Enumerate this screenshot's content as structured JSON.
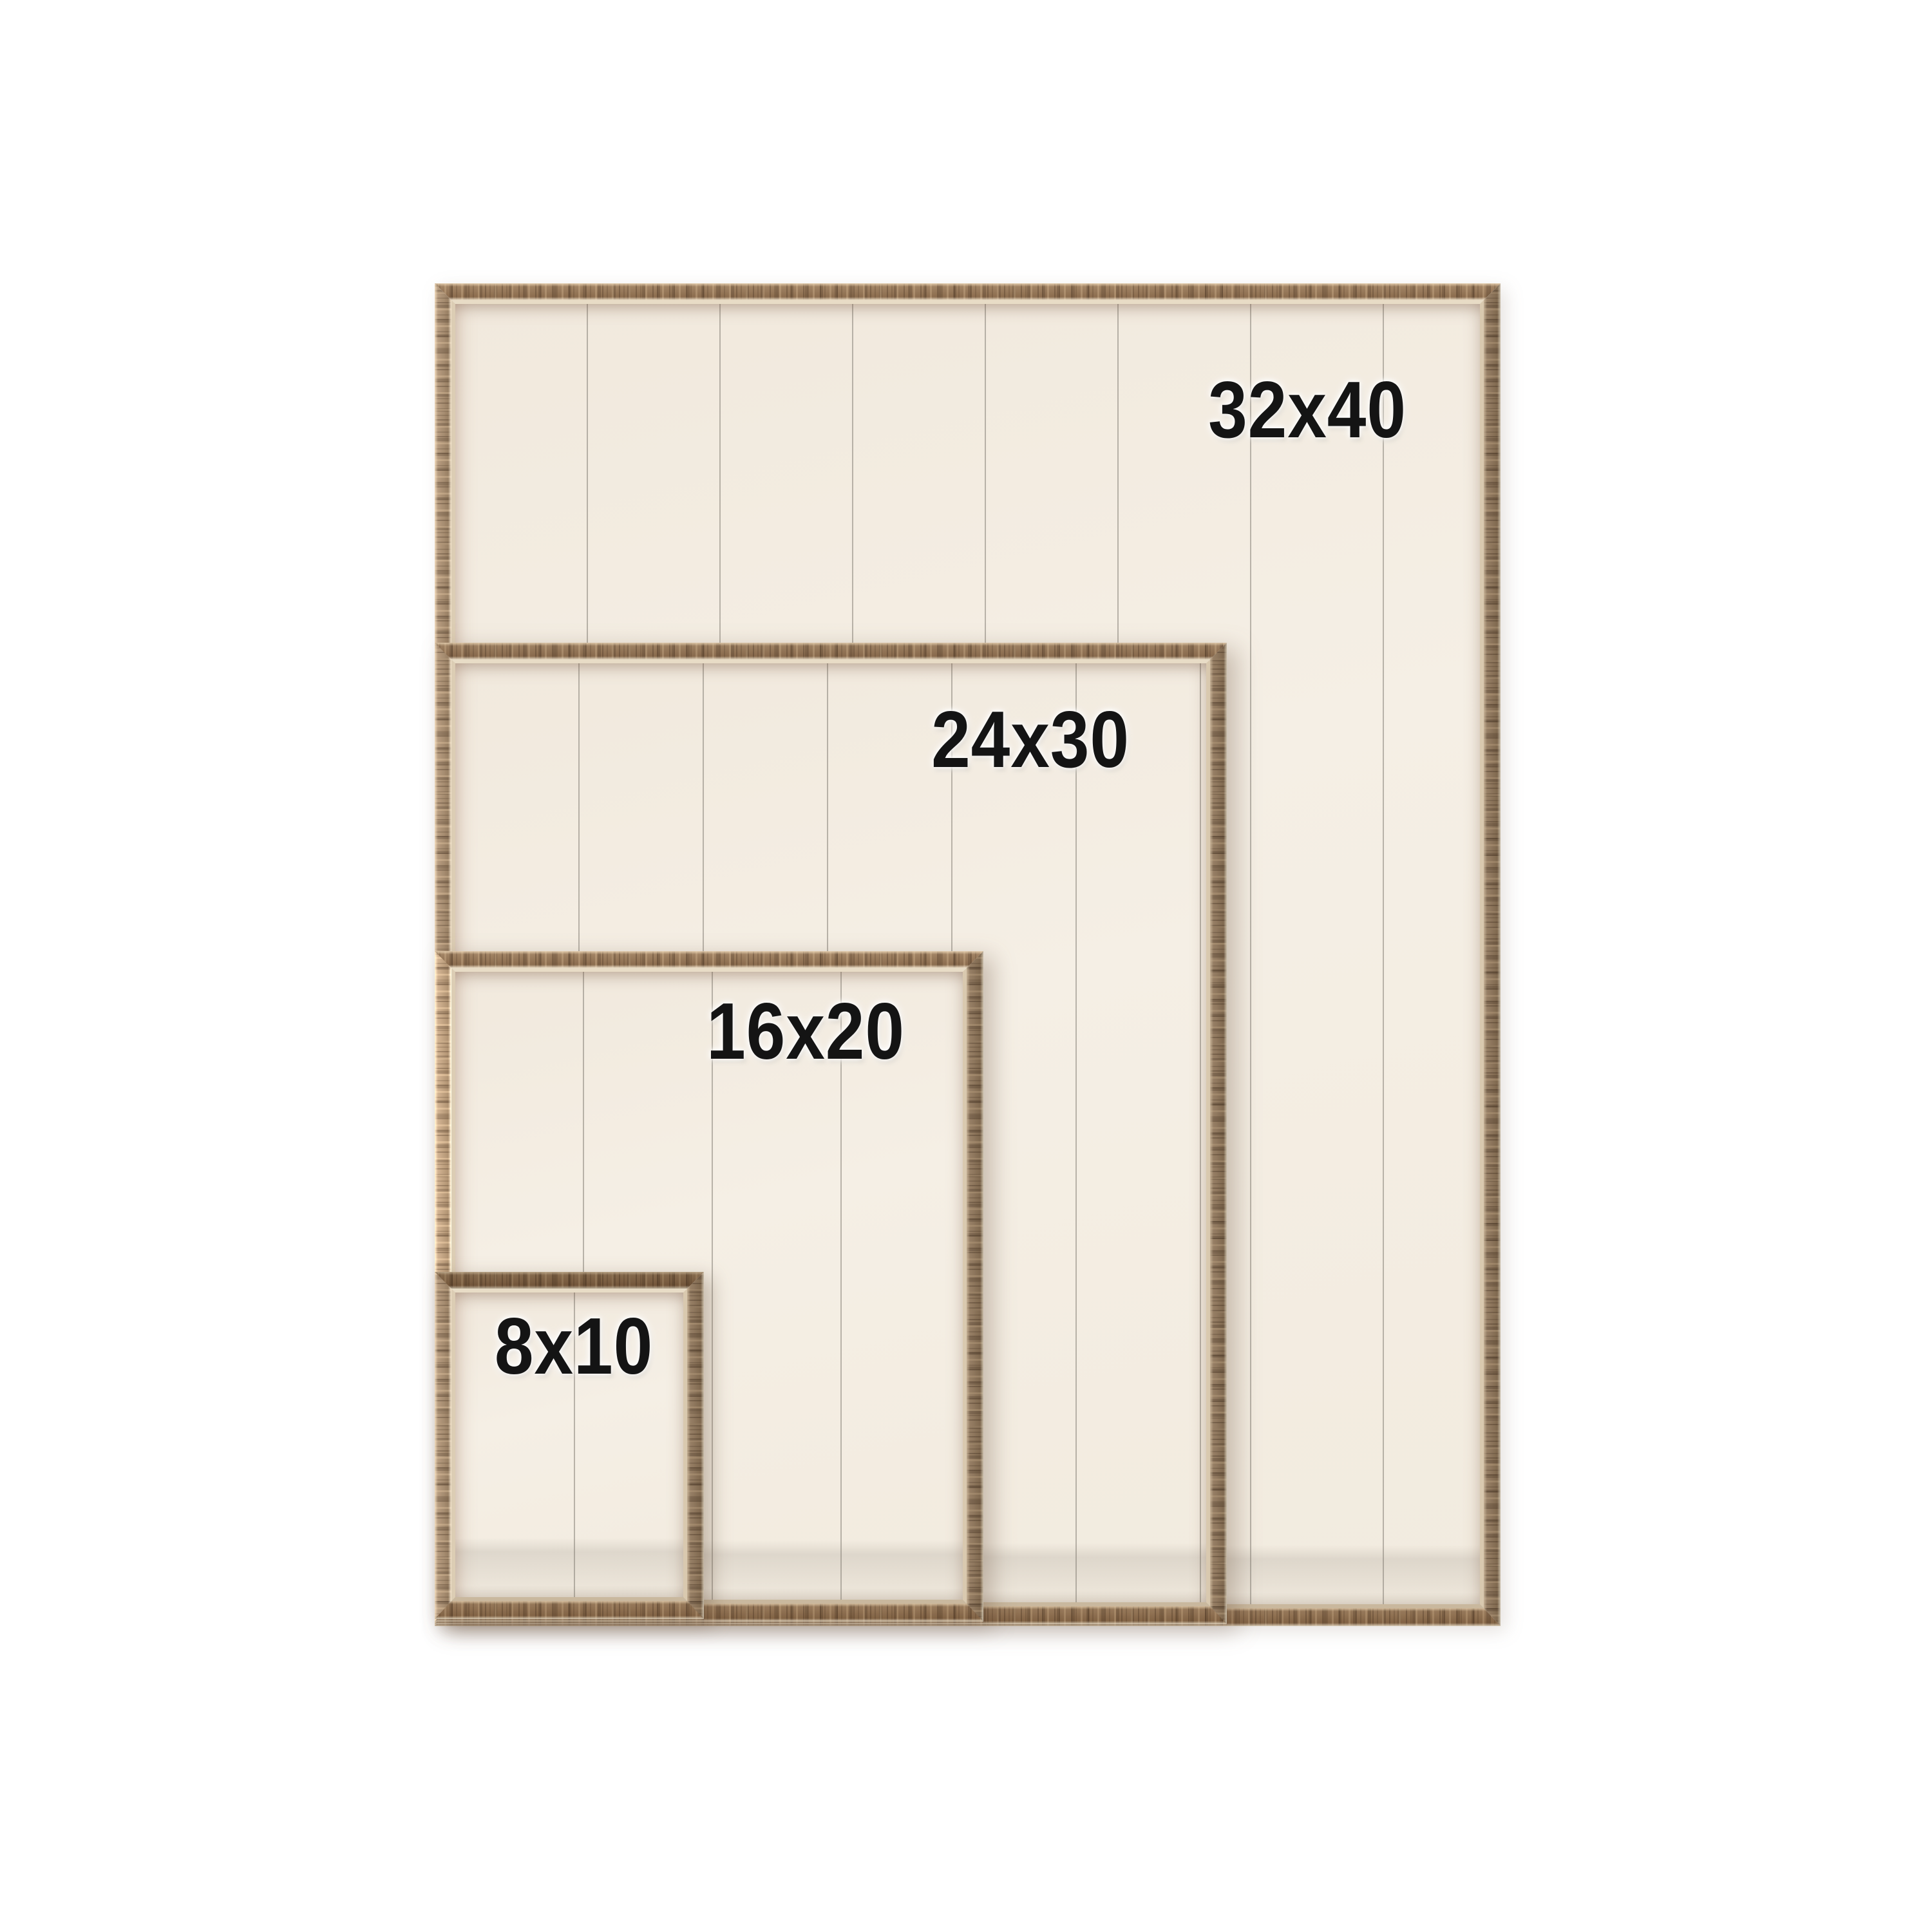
{
  "page": {
    "type": "product-size-comparison-image",
    "background_color": "#ffffff"
  },
  "frames": [
    {
      "label": "32x40"
    },
    {
      "label": "24x30"
    },
    {
      "label": "16x20"
    },
    {
      "label": "8x10"
    }
  ],
  "colors": {
    "wood_rail": "#96765a",
    "wood_rail_dark": "#8a6b4d",
    "wood_rail_light": "#ab9073",
    "frame_inner_lip": "#e0d2ba",
    "plank_backing": "#f3ecdf",
    "plank_seam": "#c9c4ba",
    "label_text": "#141414",
    "label_halo": "#ffffff"
  }
}
